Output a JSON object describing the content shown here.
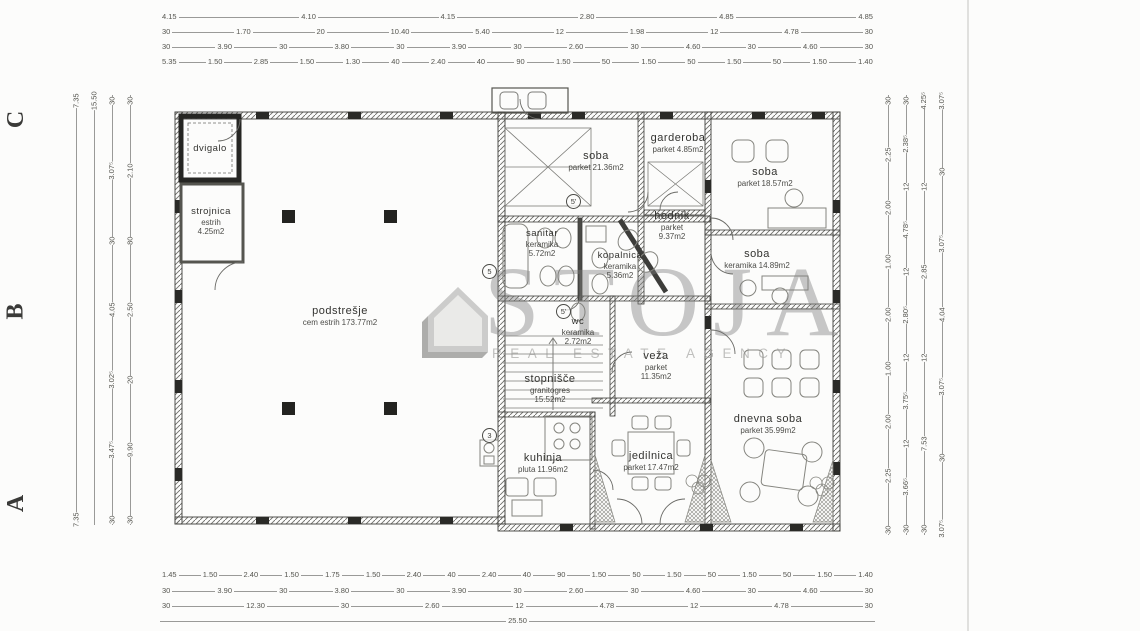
{
  "watermark": {
    "name": "STOJA",
    "tagline": "REAL ESTATE AGENCY"
  },
  "grid_letters": [
    "C",
    "B",
    "A"
  ],
  "markers": [
    {
      "label": "5'"
    },
    {
      "label": "5"
    },
    {
      "label": "5'"
    },
    {
      "label": "3"
    }
  ],
  "rooms": [
    {
      "name": "dvigalo",
      "material": "",
      "area": ""
    },
    {
      "name": "strojnica",
      "material": "estrih",
      "area": "4.25m2"
    },
    {
      "name": "podstrešje",
      "material": "cem estrih",
      "area": "173.77m2"
    },
    {
      "name": "soba",
      "material": "parket",
      "area": "21.36m2"
    },
    {
      "name": "garderoba",
      "material": "parket",
      "area": "4.85m2"
    },
    {
      "name": "soba",
      "material": "parket",
      "area": "18.57m2"
    },
    {
      "name": "hodnik",
      "material": "parket",
      "area": "9.37m2"
    },
    {
      "name": "soba",
      "material": "keramika",
      "area": "14.89m2"
    },
    {
      "name": "sanitar",
      "material": "keramika",
      "area": "5.72m2"
    },
    {
      "name": "kopalnica",
      "material": "keramika",
      "area": "5.36m2"
    },
    {
      "name": "wc",
      "material": "keramika",
      "area": "2.72m2"
    },
    {
      "name": "veža",
      "material": "parket",
      "area": "11.35m2"
    },
    {
      "name": "stopnišče",
      "material": "granitogres",
      "area": "15.52m2"
    },
    {
      "name": "kuhinja",
      "material": "pluta",
      "area": "11.96m2"
    },
    {
      "name": "jedilnica",
      "material": "parket",
      "area": "17.47m2"
    },
    {
      "name": "dnevna soba",
      "material": "parket",
      "area": "35.99m2"
    }
  ],
  "dimensions": {
    "top": {
      "row1": [
        "4.15",
        "4.10",
        "4.15",
        "2.80",
        "4.85",
        "4.85"
      ],
      "row2": [
        "30",
        "1.70",
        "20",
        "10.40",
        "5.40",
        "12",
        "1.98",
        "12",
        "4.78",
        "30"
      ],
      "row3": [
        "30",
        "3.90",
        "30",
        "3.80",
        "30",
        "3.90",
        "30",
        "2.60",
        "30",
        "4.60",
        "30",
        "4.60",
        "30"
      ],
      "row4": [
        "5.35",
        "1.50",
        "2.85",
        "1.50",
        "1.30",
        "40",
        "2.40",
        "40",
        "90",
        "1.50",
        "50",
        "1.50",
        "50",
        "1.50",
        "50",
        "1.50",
        "1.40"
      ]
    },
    "bottom": {
      "row1": [
        "1.45",
        "1.50",
        "2.40",
        "1.50",
        "1.75",
        "1.50",
        "2.40",
        "40",
        "2.40",
        "40",
        "90",
        "1.50",
        "50",
        "1.50",
        "50",
        "1.50",
        "50",
        "1.50",
        "1.40"
      ],
      "row2": [
        "30",
        "3.90",
        "30",
        "3.80",
        "30",
        "3.90",
        "30",
        "2.60",
        "30",
        "4.60",
        "30",
        "4.60",
        "30"
      ],
      "row3": [
        "30",
        "12.30",
        "30",
        "2.60",
        "12",
        "4.78",
        "12",
        "4.78",
        "30"
      ],
      "row4": [
        "25.50"
      ]
    },
    "left": {
      "chain1": [
        "7.35",
        "7.35"
      ],
      "chain2": [
        "15.50"
      ],
      "chain3": [
        "30",
        "3.07⁵",
        "30",
        "4.05",
        "3.02⁵",
        "3.47⁵",
        "30"
      ],
      "chain4": [
        "30",
        "2.10",
        "80",
        "2.50",
        "20",
        "9.90",
        "30"
      ]
    },
    "right": {
      "chain1": [
        "30",
        "2.25",
        "2.00",
        "1.00",
        "2.00",
        "1.00",
        "2.00",
        "2.25",
        "30"
      ],
      "chain2": [
        "30",
        "2.38⁵",
        "12",
        "4.78⁵",
        "12",
        "2.80⁵",
        "12",
        "3.75⁵",
        "12",
        "3.66⁵",
        "30"
      ],
      "chain3": [
        "4.25⁵",
        "12",
        "2.85",
        "12",
        "7.53",
        "30"
      ],
      "chain4": [
        "3.07⁵",
        "30",
        "3.07⁵",
        "4.04",
        "3.07⁵",
        "30",
        "3.07⁵"
      ]
    }
  }
}
